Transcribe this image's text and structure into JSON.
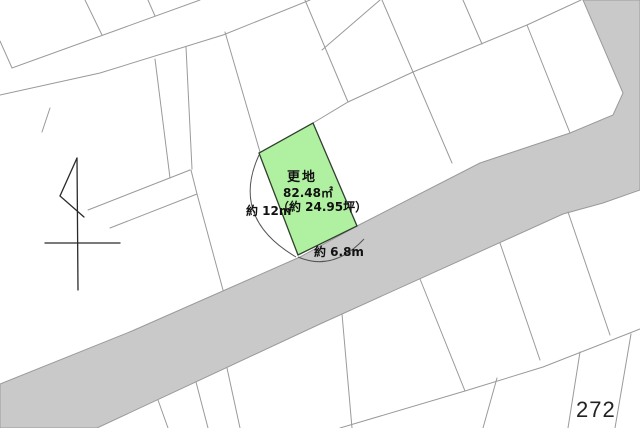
{
  "map": {
    "title": "cadastral land plot map",
    "page_number": "272",
    "plot": {
      "status_label": "更地",
      "area_m2": "82.48㎡",
      "area_tsubo": "（約 24.95坪）",
      "dimension_left": "約 12m",
      "dimension_bottom": "約 6.8m"
    },
    "colors": {
      "background": "#ffffff",
      "road_fill": "#c9c9c9",
      "parcel_line": "#9a9a9a",
      "plot_fill": "#b0f1a1",
      "plot_stroke": "#30402e",
      "arrow_stroke": "#2a2a2a",
      "arc_stroke": "#555555",
      "text": "#111111"
    },
    "geometry": {
      "road_polygon": [
        [
          0,
          384
        ],
        [
          132,
          331
        ],
        [
          300,
          257
        ],
        [
          357,
          226
        ],
        [
          480,
          163
        ],
        [
          570,
          133
        ],
        [
          613,
          115
        ],
        [
          623,
          93
        ],
        [
          583,
          0
        ],
        [
          640,
          0
        ],
        [
          640,
          190
        ],
        [
          603,
          203
        ],
        [
          563,
          214
        ],
        [
          320,
          324
        ],
        [
          97,
          428
        ],
        [
          0,
          428
        ]
      ],
      "plot_polygon": [
        [
          313,
          123
        ],
        [
          357,
          226
        ],
        [
          298,
          255
        ],
        [
          259,
          153
        ]
      ],
      "parcel_lines": [
        [
          [
            0,
            41
          ],
          [
            12,
            68
          ],
          [
            200,
            0
          ]
        ],
        [
          [
            0,
            95
          ],
          [
            100,
            73
          ],
          [
            223,
            35
          ],
          [
            310,
            0
          ]
        ],
        [
          [
            85,
            0
          ],
          [
            102,
            35
          ]
        ],
        [
          [
            148,
            0
          ],
          [
            155,
            16
          ]
        ],
        [
          [
            50,
            108
          ],
          [
            42,
            132
          ]
        ],
        [
          [
            155,
            59
          ],
          [
            170,
            178
          ]
        ],
        [
          [
            186,
            47
          ],
          [
            192,
            169
          ]
        ],
        [
          [
            88,
            210
          ],
          [
            190,
            170
          ]
        ],
        [
          [
            110,
            228
          ],
          [
            197,
            194
          ]
        ],
        [
          [
            191,
            170
          ],
          [
            197,
            194
          ],
          [
            223,
            290
          ]
        ],
        [
          [
            225,
            32
          ],
          [
            260,
            152
          ]
        ],
        [
          [
            313,
            123
          ],
          [
            348,
            102
          ],
          [
            413,
            72
          ],
          [
            527,
            25
          ],
          [
            581,
            0
          ]
        ],
        [
          [
            305,
            0
          ],
          [
            348,
            102
          ]
        ],
        [
          [
            382,
            0
          ],
          [
            413,
            72
          ]
        ],
        [
          [
            413,
            72
          ],
          [
            452,
            163
          ]
        ],
        [
          [
            527,
            25
          ],
          [
            570,
            133
          ]
        ],
        [
          [
            463,
            0
          ],
          [
            482,
            44
          ]
        ],
        [
          [
            380,
            0
          ],
          [
            322,
            50
          ]
        ],
        [
          [
            158,
            400
          ],
          [
            168,
            428
          ]
        ],
        [
          [
            196,
            382
          ],
          [
            208,
            428
          ]
        ],
        [
          [
            227,
            368
          ],
          [
            240,
            428
          ]
        ],
        [
          [
            342,
            314
          ],
          [
            352,
            428
          ]
        ],
        [
          [
            420,
            279
          ],
          [
            465,
            391
          ]
        ],
        [
          [
            500,
            243
          ],
          [
            540,
            360
          ]
        ],
        [
          [
            568,
            212
          ],
          [
            610,
            335
          ]
        ],
        [
          [
            340,
            428
          ],
          [
            465,
            391
          ],
          [
            543,
            367
          ],
          [
            640,
            329
          ]
        ],
        [
          [
            497,
            378
          ],
          [
            483,
            428
          ]
        ],
        [
          [
            580,
            352
          ],
          [
            568,
            428
          ]
        ],
        [
          [
            631,
            334
          ],
          [
            615,
            428
          ]
        ]
      ],
      "north_arrow_lines": [
        [
          [
            77,
            158
          ],
          [
            78,
            290
          ]
        ],
        [
          [
            45,
            243
          ],
          [
            120,
            243
          ]
        ],
        [
          [
            77,
            158
          ],
          [
            60,
            196
          ],
          [
            84,
            217
          ]
        ]
      ],
      "dimension_arcs": [
        "M 259 155 Q 230 218 296 257",
        "M 298 257 Q 333 272 364 239"
      ]
    }
  }
}
